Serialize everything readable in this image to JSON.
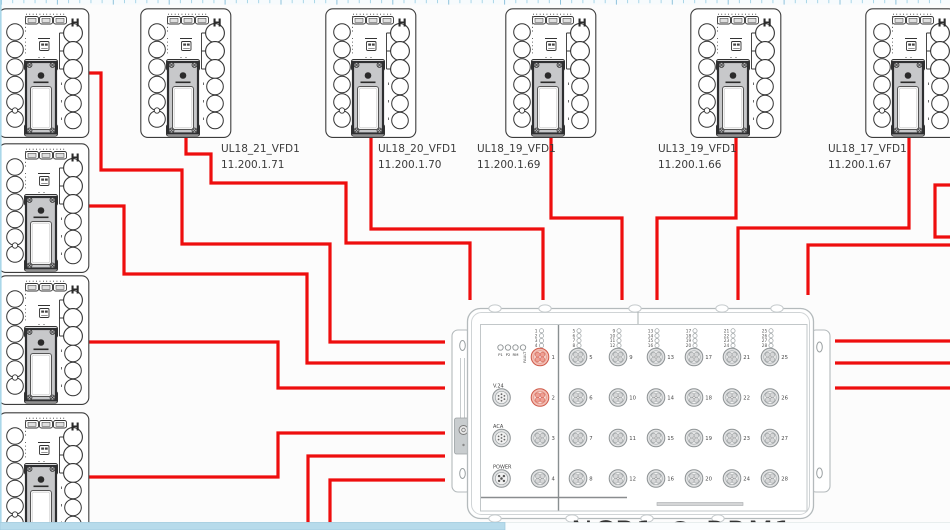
{
  "canvas": {
    "background": "#fcfcfc",
    "cable_color": "#ee0e0e",
    "highlight_port_color": "#e4695c",
    "ruler_tick_color": "#a9d6e8",
    "scrollbar_thumb_color": "#b7dbeb"
  },
  "devices": [
    {
      "id": "rack-amp-1",
      "x": -2,
      "y": 8
    },
    {
      "id": "rack-amp-2",
      "x": -2,
      "y": 143
    },
    {
      "id": "rack-amp-3",
      "x": -2,
      "y": 275
    },
    {
      "id": "rack-amp-4",
      "x": -2,
      "y": 412
    },
    {
      "id": "top-amp-1",
      "x": 140,
      "y": 8
    },
    {
      "id": "top-amp-2",
      "x": 325,
      "y": 8
    },
    {
      "id": "top-amp-3",
      "x": 505,
      "y": 8
    },
    {
      "id": "top-amp-4",
      "x": 690,
      "y": 8
    },
    {
      "id": "top-amp-5",
      "x": 865,
      "y": 8
    }
  ],
  "labels": [
    {
      "name": "UL18_21_VFD1",
      "ip": "11.200.1.71",
      "x": 221,
      "y": 152
    },
    {
      "name": "UL18_20_VFD1",
      "ip": "11.200.1.70",
      "x": 378,
      "y": 152
    },
    {
      "name": "UL18_19_VFD1",
      "ip": "11.200.1.69",
      "x": 477,
      "y": 152
    },
    {
      "name": "UL13_19_VFD1",
      "ip": "11.200.1.66",
      "x": 658,
      "y": 152
    },
    {
      "name": "UL18_17_VFD1",
      "ip": "11.200.1.67",
      "x": 828,
      "y": 152
    }
  ],
  "switch": {
    "title": "NCB1 @ RRM1",
    "status_leds": [
      "P1",
      "P2",
      "RM",
      "FAULT"
    ],
    "aux_ports": [
      "V.24",
      "ACA",
      "POWER"
    ],
    "left_ports": [
      1,
      2,
      3,
      4
    ],
    "right_port_columns": [
      [
        5,
        6,
        7,
        8
      ],
      [
        9,
        10,
        11,
        12
      ],
      [
        13,
        14,
        15,
        16
      ],
      [
        17,
        18,
        19,
        20
      ],
      [
        21,
        22,
        23,
        24
      ],
      [
        25,
        26,
        27,
        28
      ]
    ],
    "highlighted_ports": [
      1,
      2
    ]
  },
  "cables": [
    {
      "id": "cable-rack1-switch",
      "points": [
        [
          87,
          73
        ],
        [
          101,
          73
        ],
        [
          101,
          170
        ],
        [
          182,
          170
        ],
        [
          182,
          244
        ],
        [
          330,
          244
        ],
        [
          330,
          342
        ],
        [
          445,
          342
        ]
      ]
    },
    {
      "id": "cable-rack2-switch",
      "points": [
        [
          87,
          206
        ],
        [
          124,
          206
        ],
        [
          124,
          274
        ],
        [
          307,
          274
        ],
        [
          307,
          363
        ],
        [
          445,
          363
        ]
      ]
    },
    {
      "id": "cable-rack3-switch",
      "points": [
        [
          87,
          342
        ],
        [
          278,
          342
        ],
        [
          278,
          388
        ],
        [
          445,
          388
        ]
      ]
    },
    {
      "id": "cable-rack4-switch",
      "points": [
        [
          87,
          477
        ],
        [
          278,
          477
        ],
        [
          278,
          433
        ],
        [
          445,
          433
        ]
      ]
    },
    {
      "id": "cable-bottom-1",
      "points": [
        [
          308,
          524
        ],
        [
          308,
          456
        ],
        [
          445,
          456
        ]
      ]
    },
    {
      "id": "cable-bottom-2",
      "points": [
        [
          330,
          524
        ],
        [
          330,
          480
        ],
        [
          445,
          480
        ]
      ]
    },
    {
      "id": "cable-ul18-21",
      "points": [
        [
          186,
          136
        ],
        [
          186,
          154
        ],
        [
          211,
          154
        ],
        [
          211,
          183
        ],
        [
          346,
          183
        ],
        [
          346,
          243
        ],
        [
          470,
          243
        ],
        [
          470,
          300
        ]
      ]
    },
    {
      "id": "cable-ul18-20",
      "points": [
        [
          371,
          136
        ],
        [
          371,
          229
        ],
        [
          543,
          229
        ],
        [
          543,
          300
        ]
      ]
    },
    {
      "id": "cable-ul18-19",
      "points": [
        [
          551,
          136
        ],
        [
          551,
          218
        ],
        [
          622,
          218
        ],
        [
          622,
          300
        ]
      ]
    },
    {
      "id": "cable-ul13-19",
      "points": [
        [
          736,
          136
        ],
        [
          736,
          218
        ],
        [
          657,
          218
        ],
        [
          657,
          300
        ]
      ]
    },
    {
      "id": "cable-ul18-17",
      "points": [
        [
          909,
          136
        ],
        [
          909,
          228
        ],
        [
          738,
          228
        ],
        [
          738,
          300
        ]
      ]
    },
    {
      "id": "cable-right-loop",
      "points": [
        [
          950,
          185
        ],
        [
          935,
          185
        ],
        [
          935,
          237
        ],
        [
          950,
          237
        ]
      ]
    },
    {
      "id": "cable-right-in",
      "points": [
        [
          950,
          245
        ],
        [
          808,
          245
        ],
        [
          808,
          295
        ]
      ]
    },
    {
      "id": "cable-right-out-1",
      "points": [
        [
          835,
          341
        ],
        [
          950,
          341
        ]
      ]
    },
    {
      "id": "cable-right-out-2",
      "points": [
        [
          835,
          363
        ],
        [
          950,
          363
        ]
      ]
    },
    {
      "id": "cable-right-out-3",
      "points": [
        [
          835,
          388
        ],
        [
          950,
          388
        ]
      ]
    }
  ]
}
